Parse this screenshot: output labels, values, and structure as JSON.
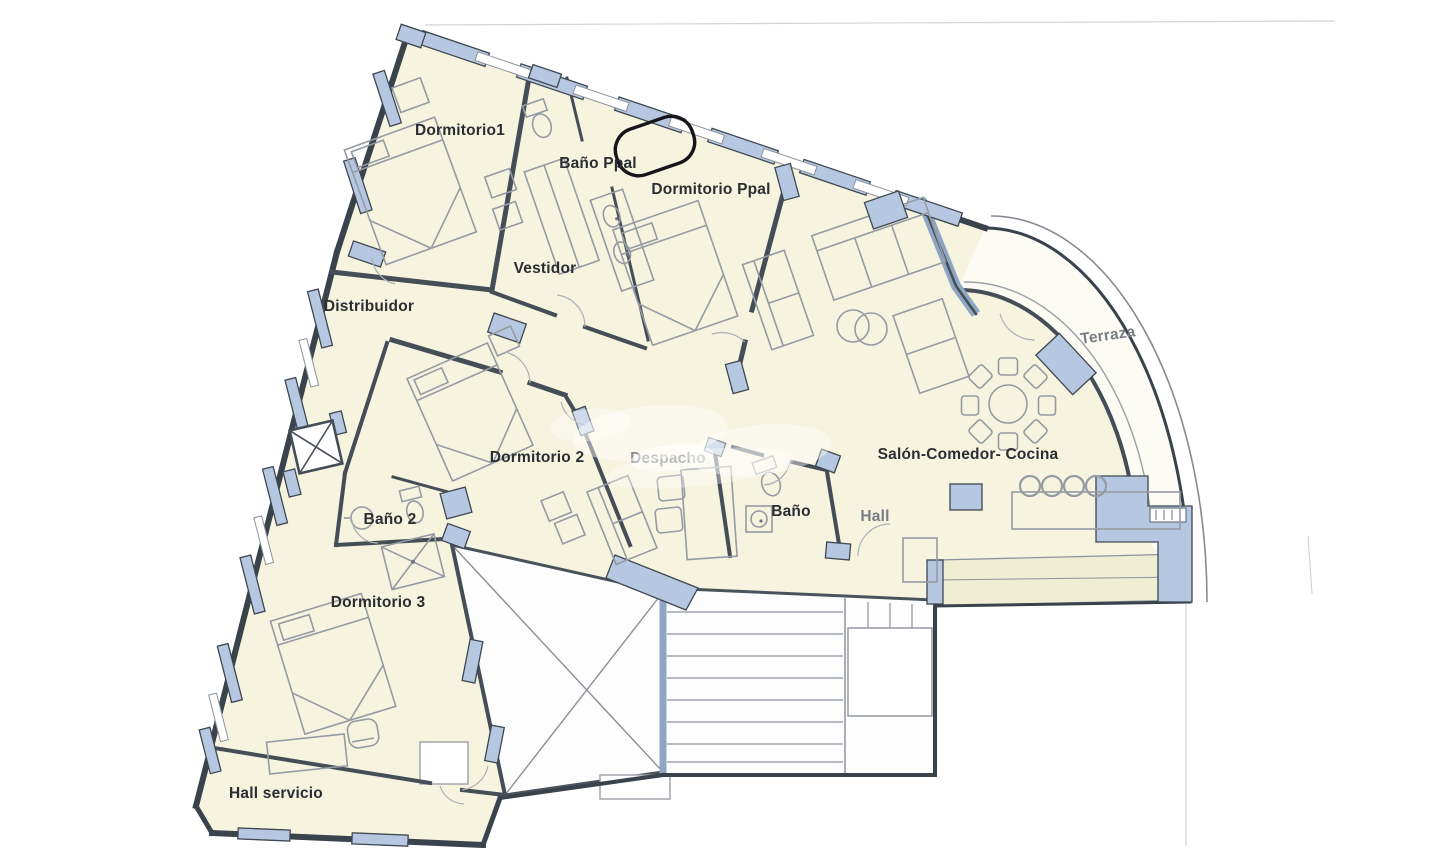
{
  "plan": {
    "rooms": {
      "dormitorio1": "Dormitorio1",
      "bano_ppal": "Baño Ppal",
      "dormitorio_ppal": "Dormitorio Ppal",
      "vestidor": "Vestidor",
      "distribuidor": "Distribuidor",
      "terraza": "Terraza",
      "dormitorio2": "Dormitorio 2",
      "despacho": "Despacho",
      "bano": "Baño",
      "hall": "Hall",
      "salon_comedor_cocina": "Salón-Comedor- Cocina",
      "bano2": "Baño 2",
      "dormitorio3": "Dormitorio 3",
      "hall_servicio": "Hall servicio"
    },
    "colors": {
      "paper": "#ffffff",
      "floor": "#f6f3df",
      "terrace_floor": "#fcfcf4",
      "band": "#f0edd5",
      "wall_fill_blue": "#b6c8e1",
      "wall_line": "#454d57",
      "furniture_line": "#959ba3",
      "label_text": "#2a2e33"
    }
  }
}
